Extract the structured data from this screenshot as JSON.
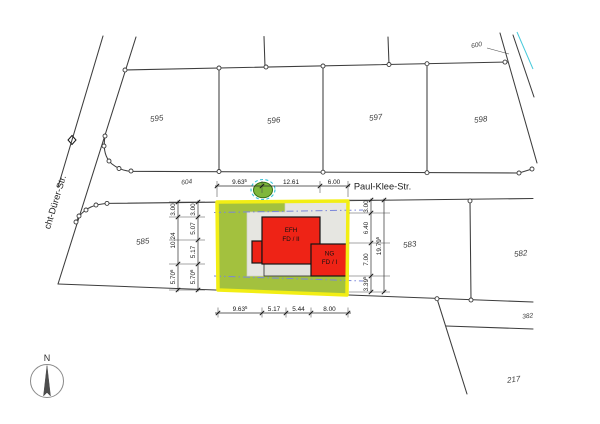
{
  "streets": {
    "paul_klee": "Paul-Klee-Str.",
    "duerer": "cht-Dürer-Str."
  },
  "parcels": {
    "p595": "595",
    "p596": "596",
    "p597": "597",
    "p598": "598",
    "p600": "600",
    "p604": "604",
    "p585": "585",
    "p583": "583",
    "p582": "582",
    "p382": "382",
    "p217": "217"
  },
  "buildings": {
    "efh_line1": "EFH",
    "efh_line2": "FD / II",
    "ng_line1": "NG",
    "ng_line2": "FD / I"
  },
  "north_arrow": {
    "label": "N"
  },
  "dims": {
    "top": [
      {
        "v": "9.63",
        "sup": "5"
      },
      {
        "v": "12.61"
      },
      {
        "v": "6.00"
      }
    ],
    "left_outer": [
      {
        "v": "3.00"
      },
      {
        "v": "10.24"
      },
      {
        "v": "5.70",
        "sup": "6"
      }
    ],
    "left_inner": [
      {
        "v": "3.00"
      },
      {
        "v": "5.07"
      },
      {
        "v": "5.17"
      },
      {
        "v": "5.70",
        "sup": "6"
      }
    ],
    "right_inner": [
      {
        "v": "3.00"
      },
      {
        "v": "6.40"
      },
      {
        "v": "7.00"
      },
      {
        "v": "3.39",
        "sup": "5"
      }
    ],
    "right_outer": [
      {
        "v": "19.79",
        "sup": "5"
      }
    ],
    "bottom": [
      {
        "v": "9.63",
        "sup": "5"
      },
      {
        "v": "5.17"
      },
      {
        "v": "5.44"
      },
      {
        "v": "8.00"
      }
    ]
  },
  "colors": {
    "highlight_boundary": "#f2ee14",
    "garden": "#a3c13e",
    "paved": "#e6e6e1",
    "building": "#ee2316",
    "setback_line": "#7b87d9",
    "tree_outline": "#35c4d8",
    "tree_fill": "#7fb73a"
  }
}
